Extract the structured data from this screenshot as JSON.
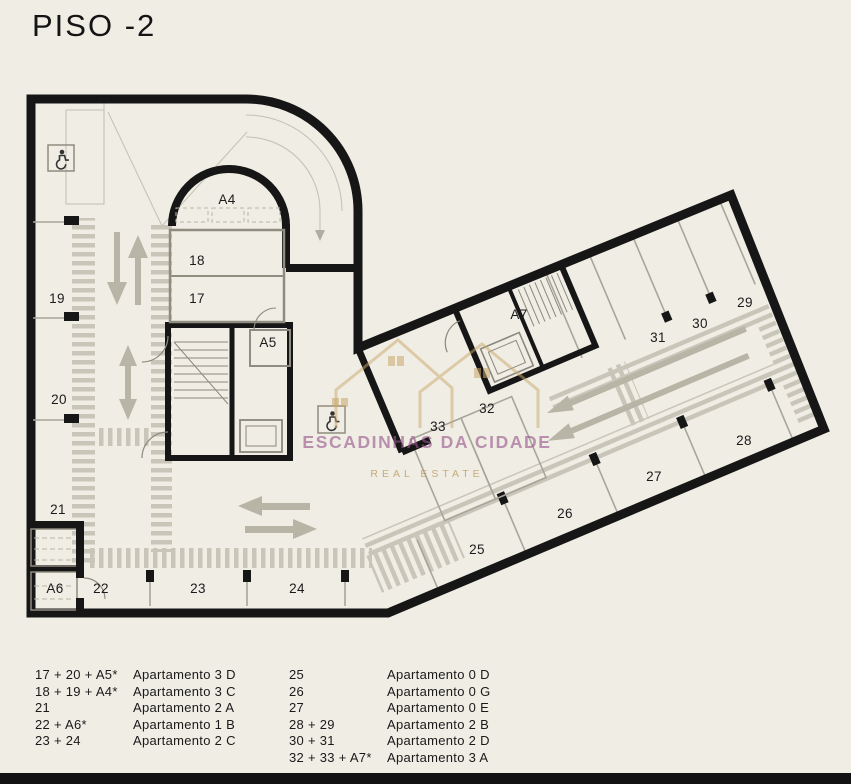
{
  "title": "PISO -2",
  "colors": {
    "background": "#f0ede5",
    "walls": "#161616",
    "hatch": "#c9c5b9",
    "detail_gray": "#a8a59a",
    "arrow_gray": "#b8b4a6",
    "watermark_purple": "#96568b",
    "watermark_gold": "#c1a068"
  },
  "watermark": {
    "line1": "ESCADINHAS DA CIDADE",
    "line2": "REAL ESTATE"
  },
  "plan": {
    "spots": [
      {
        "label": "17"
      },
      {
        "label": "18"
      },
      {
        "label": "19"
      },
      {
        "label": "20"
      },
      {
        "label": "21"
      },
      {
        "label": "22"
      },
      {
        "label": "23"
      },
      {
        "label": "24"
      },
      {
        "label": "25"
      },
      {
        "label": "26"
      },
      {
        "label": "27"
      },
      {
        "label": "28"
      },
      {
        "label": "29"
      },
      {
        "label": "30"
      },
      {
        "label": "31"
      },
      {
        "label": "32"
      },
      {
        "label": "33"
      },
      {
        "label": "A4"
      },
      {
        "label": "A5"
      },
      {
        "label": "A6"
      },
      {
        "label": "A7"
      }
    ]
  },
  "legend": {
    "columns": [
      {
        "rows": [
          {
            "code": "17 + 20 + A5*",
            "name": "Apartamento 3 D"
          },
          {
            "code": "18 + 19 + A4*",
            "name": "Apartamento 3 C"
          },
          {
            "code": "21",
            "name": "Apartamento 2 A"
          },
          {
            "code": "22 + A6*",
            "name": "Apartamento 1 B"
          },
          {
            "code": "23 + 24",
            "name": "Apartamento 2 C"
          }
        ]
      },
      {
        "rows": [
          {
            "code": "25",
            "name": "Apartamento 0 D"
          },
          {
            "code": "26",
            "name": "Apartamento 0 G"
          },
          {
            "code": "27",
            "name": "Apartamento 0 E"
          },
          {
            "code": "28 + 29",
            "name": "Apartamento 2 B"
          },
          {
            "code": "30 + 31",
            "name": "Apartamento 2 D"
          },
          {
            "code": "32 + 33 + A7*",
            "name": "Apartamento 3 A"
          }
        ]
      }
    ]
  }
}
